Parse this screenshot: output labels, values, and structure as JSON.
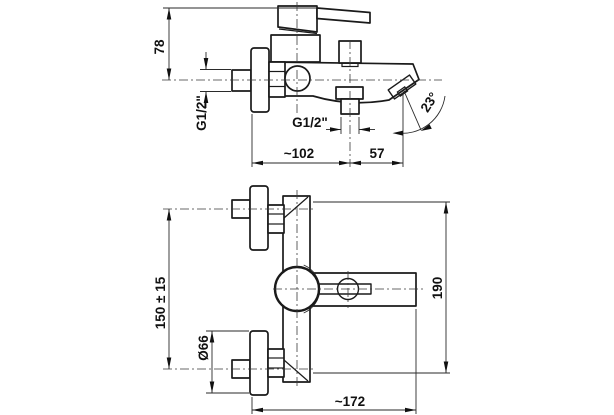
{
  "drawing": {
    "type": "technical-drawing",
    "subject": "wall-mounted bath mixer faucet, two orthographic views with dimensions",
    "colors": {
      "background": "#ffffff",
      "line": "#1a1a1a",
      "text": "#111111"
    },
    "side_view": {
      "dim_height": "78",
      "dim_inlet_thread": "G1/2\"",
      "dim_outlet_thread": "G1/2\"",
      "dim_wall_to_outlet": "~102",
      "dim_outlet_to_spout": "57",
      "dim_spout_angle": "23°"
    },
    "front_view": {
      "dim_inlet_spacing": "150 ± 15",
      "dim_flange_diameter": "Ø66",
      "dim_overall_length": "~172",
      "dim_overall_height": "190"
    }
  }
}
